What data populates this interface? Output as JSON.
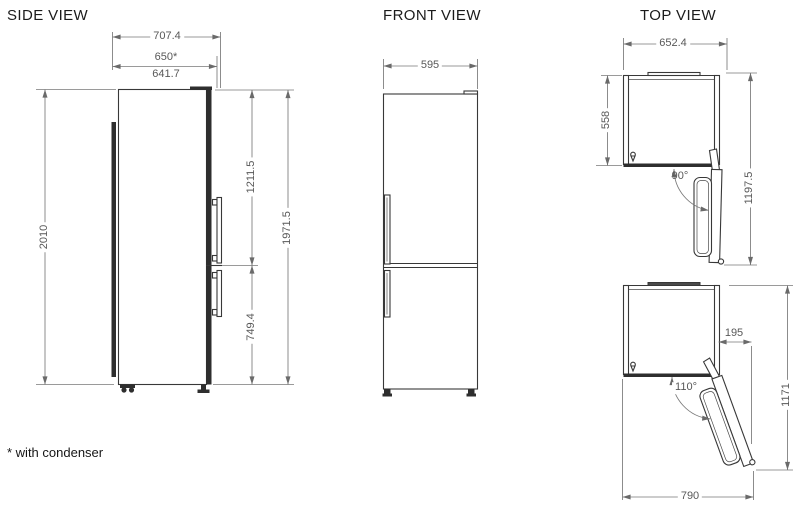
{
  "footnote": "* with condenser",
  "side_view": {
    "title": "SIDE VIEW",
    "dim_depth_overall": "707.4",
    "dim_depth_with_condenser": "650*",
    "dim_depth_body": "641.7",
    "dim_height_overall": "2010",
    "dim_fridge_door_height": "1211.5",
    "dim_freezer_door_height": "749.4",
    "dim_doors_height": "1971.5"
  },
  "front_view": {
    "title": "FRONT VIEW",
    "dim_width": "595"
  },
  "top_view": {
    "title": "TOP VIEW",
    "dim_width_overall": "652.4",
    "dim_depth_no_door": "558",
    "dim_open_90_angle": "90°",
    "dim_open_90_depth": "1197.5",
    "dim_open_110_side_offset": "195",
    "dim_open_110_angle": "110°",
    "dim_open_110_depth": "1171",
    "dim_open_110_width": "790"
  }
}
